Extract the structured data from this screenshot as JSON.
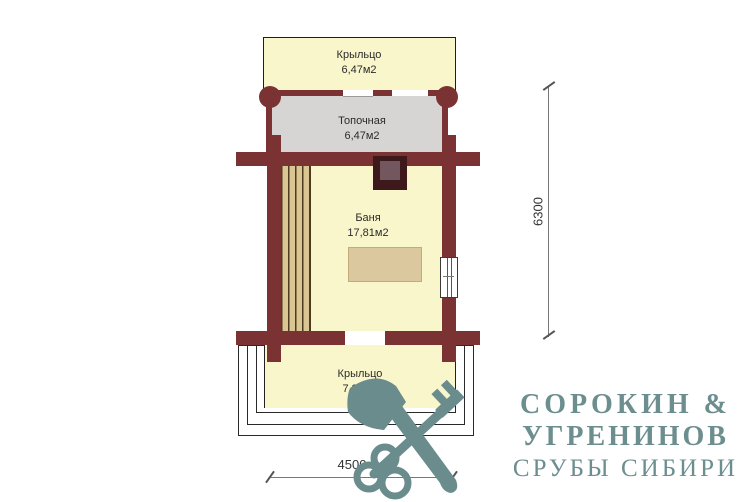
{
  "plan": {
    "rooms": {
      "porch_top": {
        "name": "Крыльцо",
        "area": "6,47м2"
      },
      "furnace_room": {
        "name": "Топочная",
        "area": "6,47м2"
      },
      "bath_room": {
        "name": "Баня",
        "area": "17,81м2"
      },
      "porch_bottom": {
        "name": "Крыльцо",
        "area": "7,87м2"
      }
    },
    "dimensions": {
      "vertical": "6300",
      "horizontal": "4500"
    },
    "features": {
      "stove": "печь",
      "window": "окно",
      "bench": "полок"
    }
  },
  "logo": {
    "line1": "СОРОКИН &",
    "line2": "УГРЕНИНОВ",
    "line3": "СРУБЫ СИБИРИ",
    "icon": "axe-and-key-icon"
  },
  "colors": {
    "wall": "#7b3232",
    "floor_cream": "#faf6cb",
    "floor_gray": "#d6d5d3",
    "stove_dark": "#3d191c",
    "stove_inner": "#73575f",
    "bench_wood": "#d9c693",
    "table_wood": "#dcc89e",
    "logo_teal": "#6b8c8d"
  }
}
